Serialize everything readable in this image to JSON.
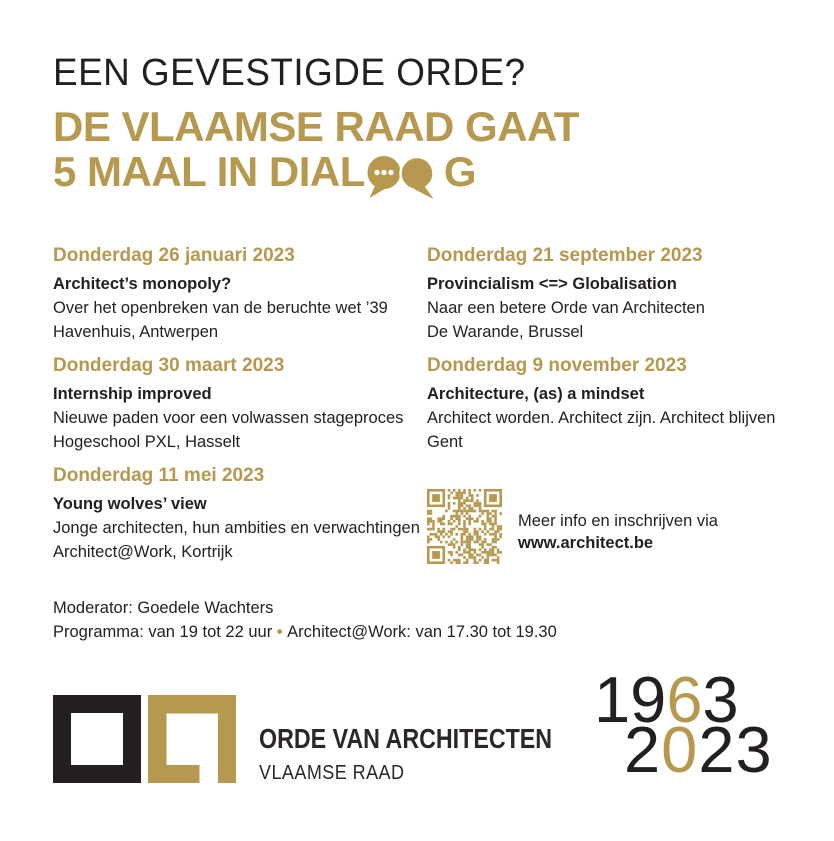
{
  "colors": {
    "gold": "#B6984E",
    "ink": "#231F20"
  },
  "header": {
    "kicker": "EEN GEVESTIGDE ORDE?",
    "headline_line1": "DE VLAAMSE RAAD GAAT",
    "headline_line2_before": "5 MAAL IN DIAL",
    "headline_line2_after": "G"
  },
  "events": [
    {
      "date": "Donderdag 26 januari 2023",
      "title": "Architect’s monopoly?",
      "description": "Over het openbreken van de beruchte wet ’39",
      "location": "Havenhuis, Antwerpen"
    },
    {
      "date": "Donderdag 30 maart 2023",
      "title": "Internship improved",
      "description": "Nieuwe paden voor een volwassen stageproces",
      "location": "Hogeschool PXL, Hasselt"
    },
    {
      "date": "Donderdag 11 mei 2023",
      "title": "Young wolves’ view",
      "description": "Jonge architecten, hun ambities en verwachtingen",
      "location": "Architect@Work, Kortrijk"
    },
    {
      "date": "Donderdag 21 september 2023",
      "title": "Provincialism <=> Globalisation",
      "description": "Naar een betere Orde van Architecten",
      "location": "De Warande, Brussel"
    },
    {
      "date": "Donderdag 9 november 2023",
      "title": "Architecture, (as) a mindset",
      "description": "Architect worden. Architect zijn. Architect blijven",
      "location": "Gent"
    }
  ],
  "info": {
    "line1": "Meer info en inschrijven via",
    "url": "www.architect.be"
  },
  "notes": {
    "moderator": "Moderator: Goedele Wachters",
    "programma_part1": "Programma: van 19 tot 22 uur",
    "bullet": "•",
    "programma_part2": "Architect@Work: van 17.30 tot 19.30"
  },
  "brand": {
    "name": "ORDE VAN ARCHITECTEN",
    "subtitle": "VLAAMSE RAAD"
  },
  "anniversary": {
    "y1a": "19",
    "y1b": "6",
    "y1c": "3",
    "y2a": "2",
    "y2b": "0",
    "y2c": "23"
  }
}
